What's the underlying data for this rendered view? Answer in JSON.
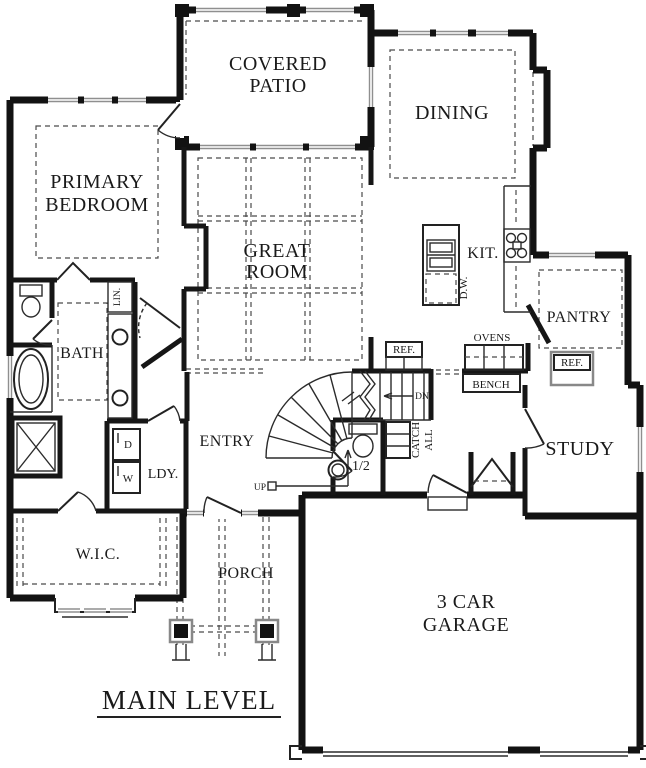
{
  "drawing": {
    "type": "residential-floor-plan",
    "title": "MAIN LEVEL"
  },
  "colors": {
    "background": "#ffffff",
    "walls": "#121212",
    "thin_lines": "#2b2b2b",
    "dashed_lines": "#4a4a4a",
    "window_gray": "#8f8f8f",
    "text": "#1a1a1a"
  },
  "labels": {
    "covered_patio_1": "COVERED",
    "covered_patio_2": "PATIO",
    "dining": "DINING",
    "primary_1": "PRIMARY",
    "primary_2": "BEDROOM",
    "great_1": "GREAT",
    "great_2": "ROOM",
    "kitchen": "KIT.",
    "dishwasher": "D.W.",
    "pantry": "PANTRY",
    "ovens": "OVENS",
    "bench": "BENCH",
    "ref_kitchen": "REF.",
    "ref_pantry": "REF.",
    "bath": "BATH",
    "linen": "LIN.",
    "laundry": "LDY.",
    "dryer": "D",
    "washer": "W",
    "entry": "ENTRY",
    "up": "UP",
    "down": "DN",
    "catch_all_1": "CATCH",
    "catch_all_2": "ALL",
    "half_bath": "1/2",
    "study": "STUDY",
    "walk_in_closet": "W.I.C.",
    "porch": "PORCH",
    "garage_1": "3 CAR",
    "garage_2": "GARAGE",
    "title": "MAIN LEVEL"
  }
}
